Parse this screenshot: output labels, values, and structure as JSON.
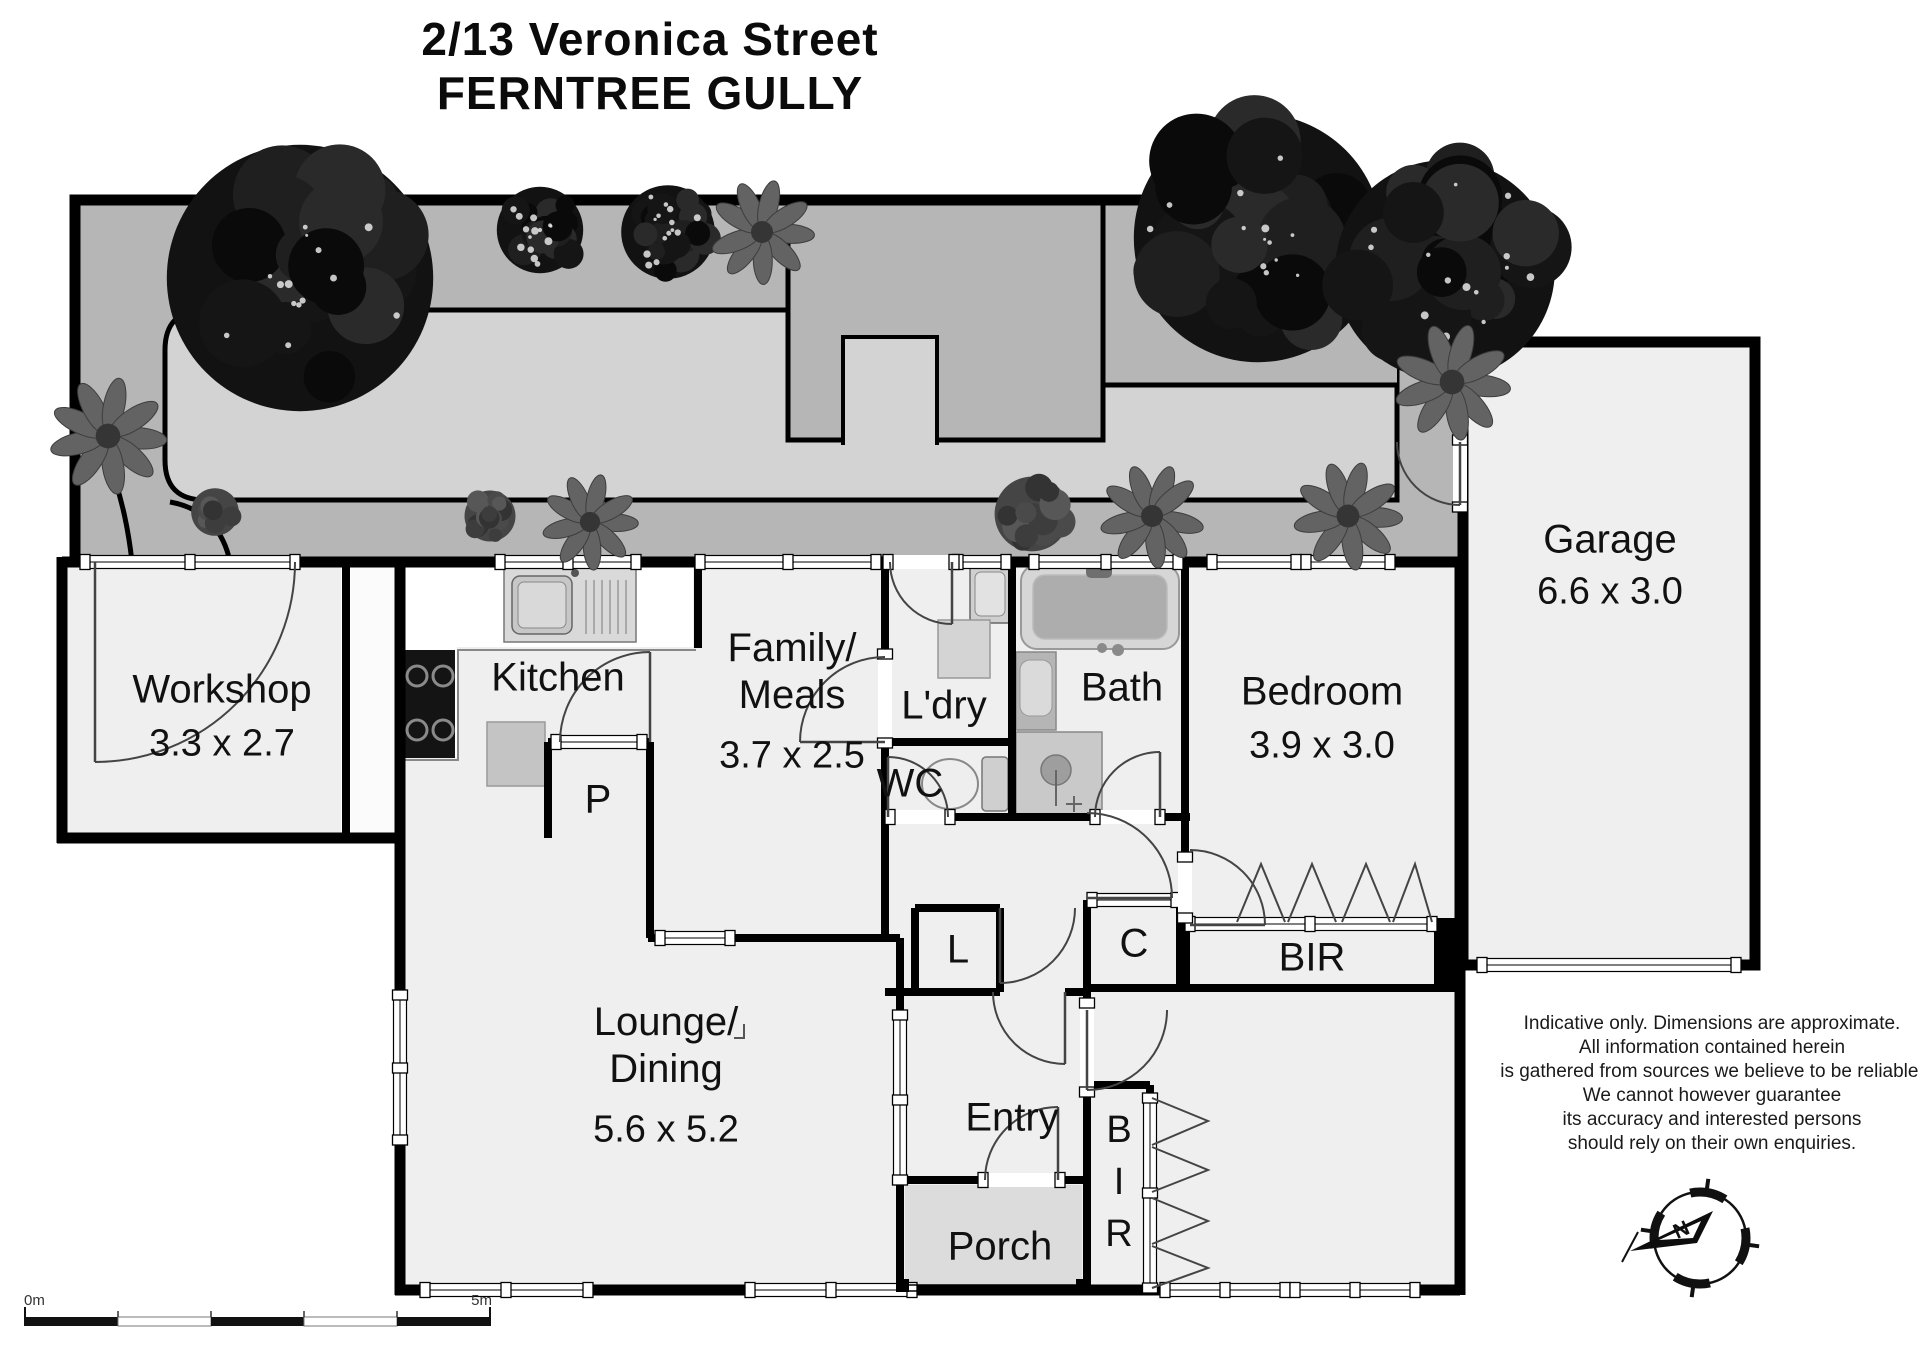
{
  "title": {
    "line1": "2/13 Veronica Street",
    "line2": "FERNTREE GULLY"
  },
  "rooms": {
    "workshop": {
      "name": "Workshop",
      "dims": "3.3 x 2.7"
    },
    "kitchen": {
      "name": "Kitchen"
    },
    "family": {
      "name": "Family/\nMeals",
      "dims": "3.7 x 2.5"
    },
    "laundry": {
      "name": "L'dry"
    },
    "wc": {
      "name": "WC"
    },
    "bath": {
      "name": "Bath"
    },
    "bedroom1": {
      "name": "Bedroom",
      "dims": "3.9 x 3.0"
    },
    "garage": {
      "name": "Garage",
      "dims": "6.6 x 3.0"
    },
    "lounge": {
      "name": "Lounge/\nDining",
      "dims": "5.6 x 5.2"
    },
    "entry": {
      "name": "Entry"
    },
    "porch": {
      "name": "Porch"
    }
  },
  "closets": {
    "pantry": "P",
    "linen": "L",
    "cupboard": "C",
    "bir_bed1": "BIR",
    "bir_bed2": "B\nI\nR"
  },
  "disclaimer": {
    "lines": [
      "Indicative only. Dimensions are approximate.",
      "All information contained herein",
      "is gathered from sources we believe to be reliable.",
      "We cannot however guarantee",
      "its accuracy and interested persons",
      "should rely on their own enquiries."
    ]
  },
  "scale_bar": {
    "start_label": "0m",
    "end_label": "5m"
  },
  "compass": {
    "north_label": "N"
  },
  "colors": {
    "wall": "#000000",
    "yard_path": "#b6b6b6",
    "lawn": "#d3d3d3",
    "floor": "#efefef",
    "porch": "#dcdcdc"
  }
}
